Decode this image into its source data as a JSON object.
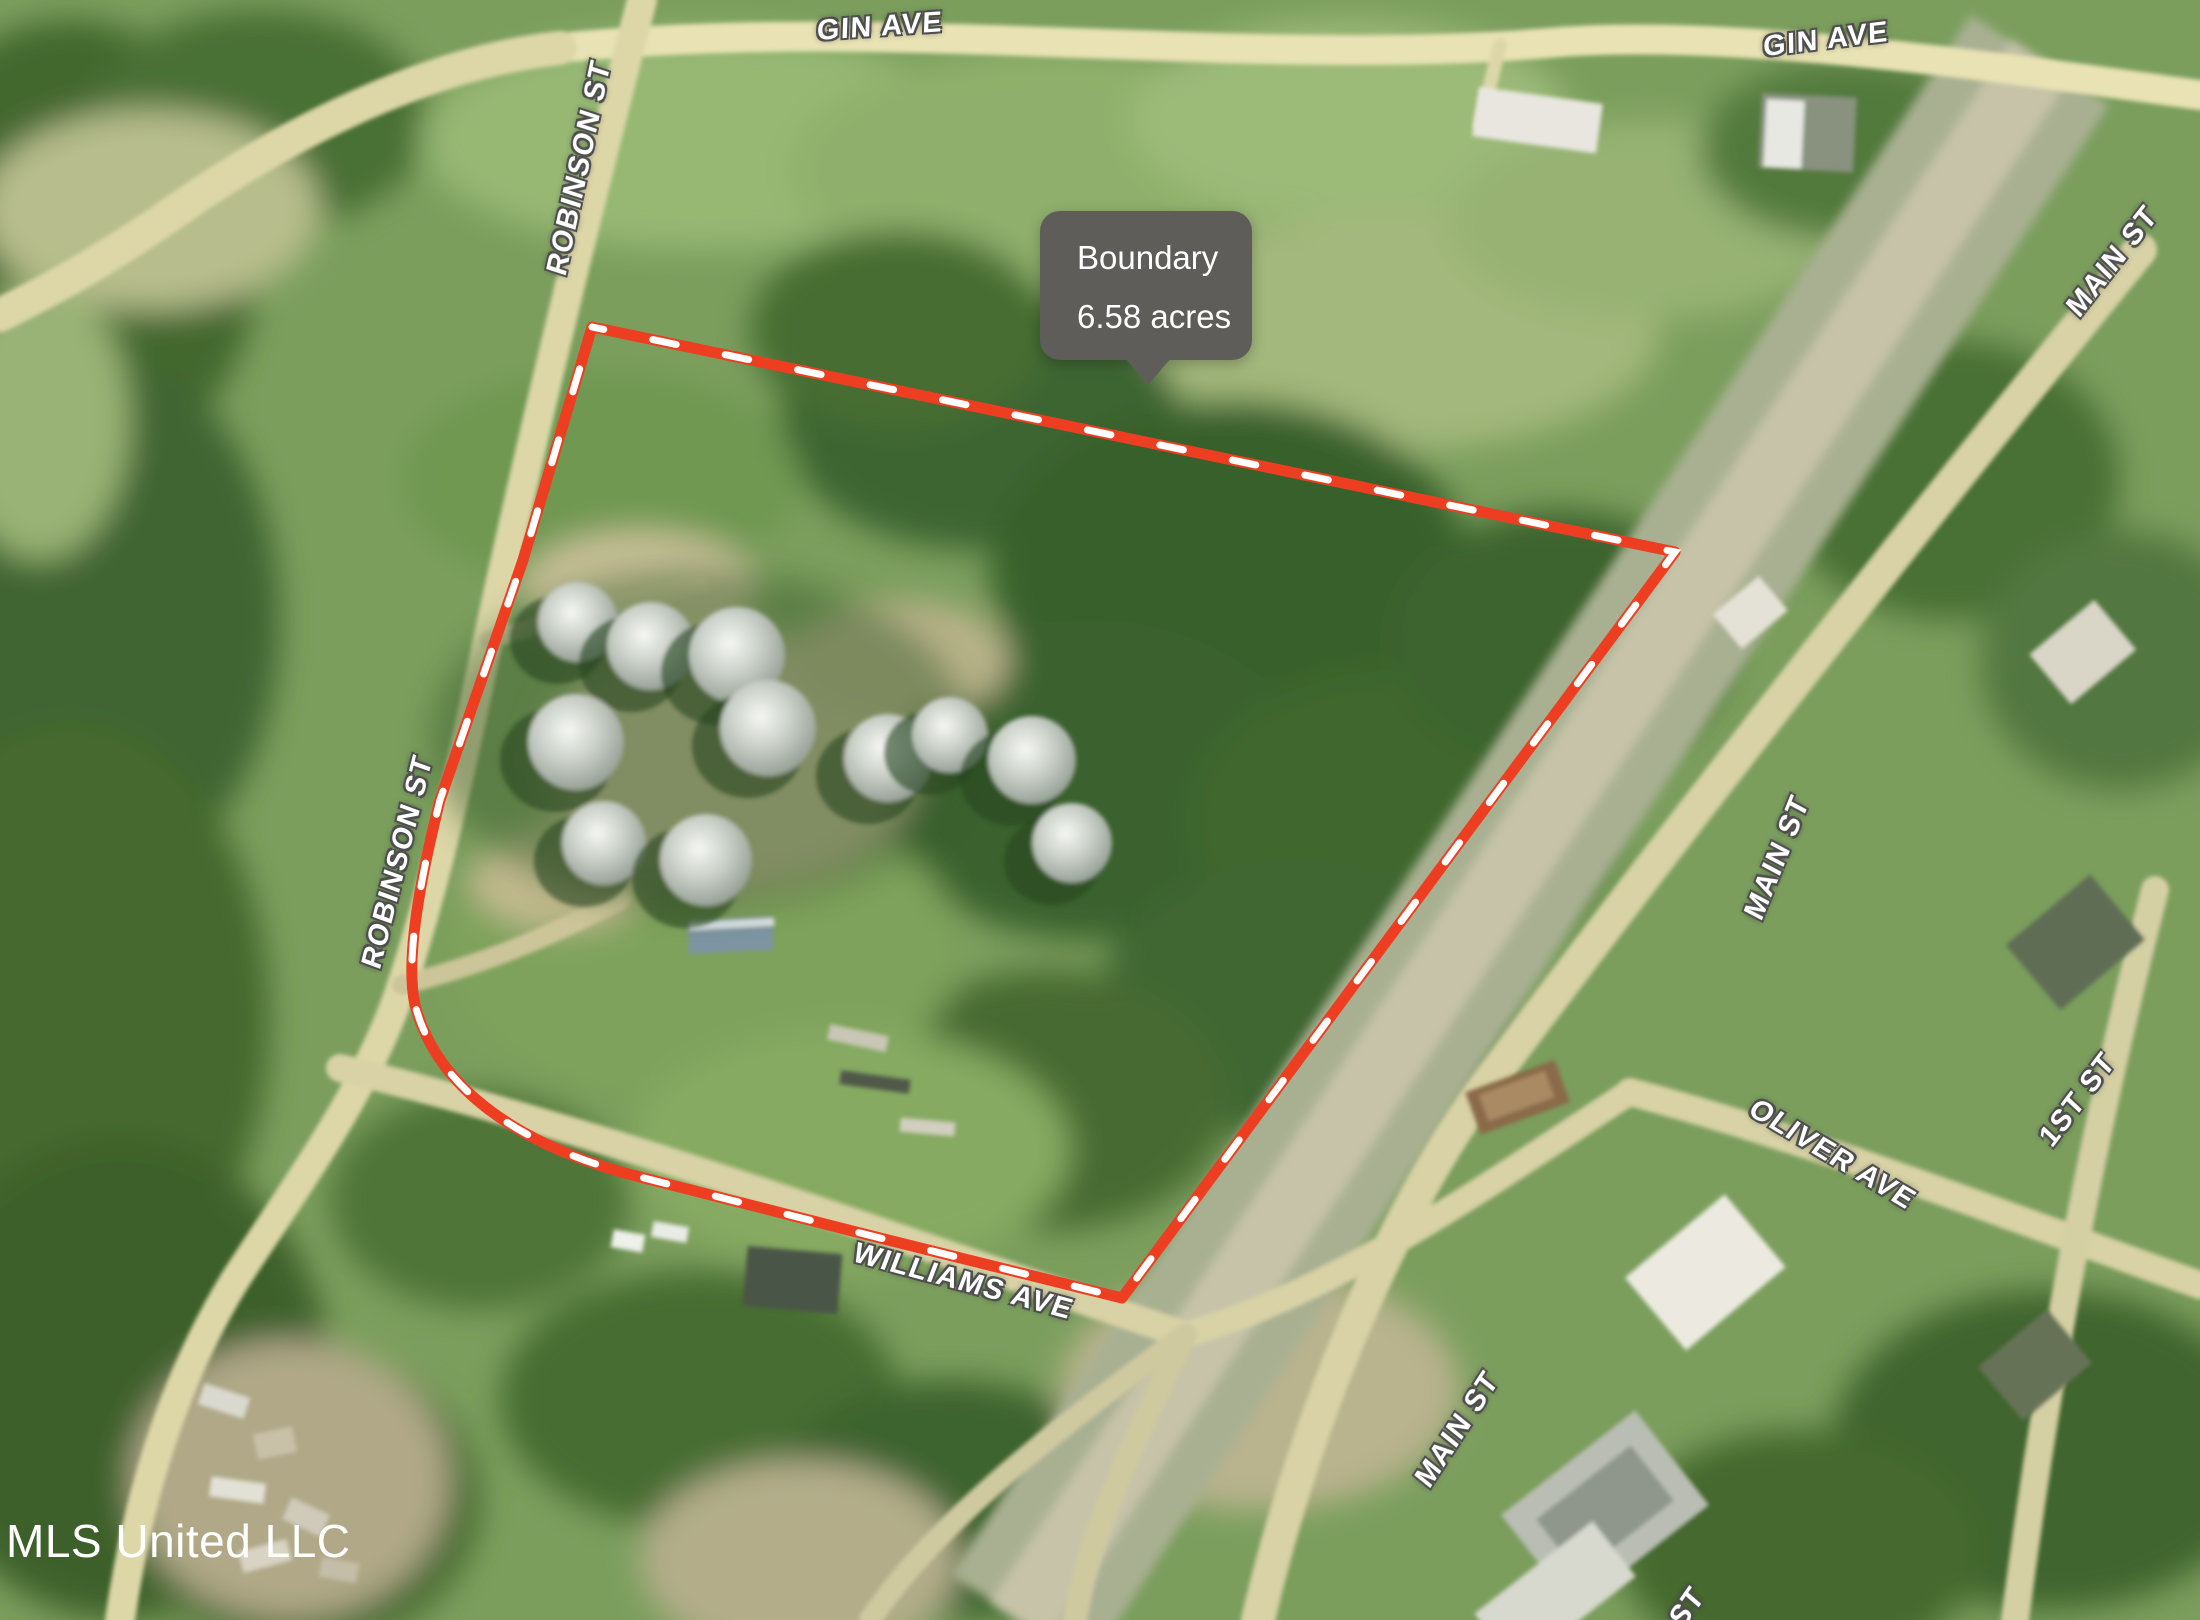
{
  "map": {
    "attribution": "MLS United LLC",
    "tooltip": {
      "title": "Boundary",
      "subtitle": "6.58 acres",
      "bg_color": "#5e5d59",
      "text_color": "#ffffff"
    },
    "boundary": {
      "area_acres": "6.58",
      "line_color": "#ee3e22",
      "dash_color": "#ffffff"
    },
    "street_labels": [
      {
        "id": "gin-ave-1",
        "text": "GIN AVE"
      },
      {
        "id": "gin-ave-2",
        "text": "GIN AVE"
      },
      {
        "id": "robinson-st-1",
        "text": "ROBINSON ST"
      },
      {
        "id": "robinson-st-2",
        "text": "ROBINSON ST"
      },
      {
        "id": "main-st-1",
        "text": "MAIN ST"
      },
      {
        "id": "main-st-2",
        "text": "MAIN ST"
      },
      {
        "id": "main-st-3",
        "text": "MAIN ST"
      },
      {
        "id": "oliver-ave",
        "text": "OLIVER AVE"
      },
      {
        "id": "first-st",
        "text": "1ST ST"
      },
      {
        "id": "williams-ave",
        "text": "WILLIAMS AVE"
      },
      {
        "id": "st-partial",
        "text": "ST"
      }
    ]
  }
}
